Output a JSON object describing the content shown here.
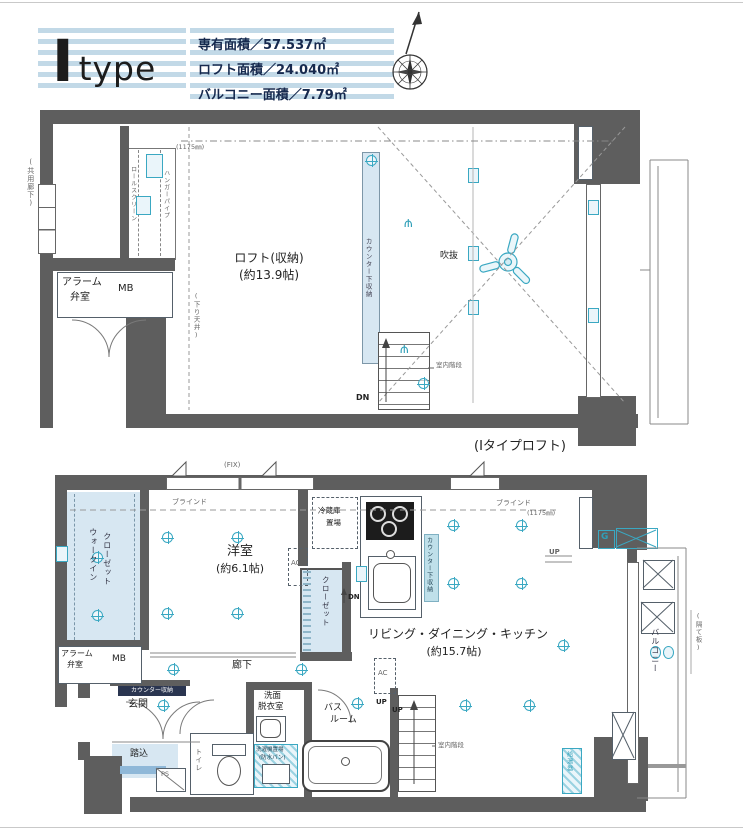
{
  "header": {
    "logo": {
      "letter": "I",
      "word": "type"
    },
    "areas": {
      "line1": "専有面積／57.537㎡",
      "line2": "ロフト面積／24.040㎡",
      "line3": "バルコニー面積／7.79㎡"
    }
  },
  "upper_plan": {
    "caption": "(Iタイプロフト)",
    "labels": {
      "corridor_side": "(共用廊下)",
      "alarm_line1": "アラーム",
      "alarm_line2": "弁室",
      "mb": "MB",
      "roll_screen": "ロールスクリーン",
      "hanger_pipe": "ハンガーパイプ",
      "dim_note": "(1175㎜)",
      "loft_name": "ロフト(収納)",
      "loft_size": "(約13.9帖)",
      "lowered_ceiling": "(下り天井)",
      "counter_storage": "カウンター下収納",
      "void": "吹抜",
      "dn": "DN",
      "stairs_note": "室内階段"
    }
  },
  "lower_plan": {
    "labels": {
      "fix": "(FIX)",
      "blind": "ブラインド",
      "dim_note": "(1175㎜)",
      "wic_line1": "ウォークイン",
      "wic_line2": "クローゼット",
      "bedroom_name": "洋室",
      "bedroom_size": "(約6.1帖)",
      "closet": "クローゼット",
      "fridge_line1": "冷蔵庫",
      "fridge_line2": "置場",
      "ac": "AC",
      "counter_storage": "カウンター下収納",
      "dn": "DN",
      "ldk_name": "リビング・ダイニング・キッチン",
      "ldk_size": "(約15.7帖)",
      "gas_meter": "G",
      "up": "UP",
      "balcony": "バルコニー",
      "partition": "(隔て板)",
      "water_heater": "給湯器",
      "alarm_line1": "アラーム",
      "alarm_line2": "弁室",
      "mb": "MB",
      "hallway": "廊下",
      "entrance": "玄関",
      "entrance_counter": "カウンター収納",
      "step_in": "踏込",
      "ps": "PS",
      "toilet": "トイレ",
      "washroom_line1": "洗面",
      "washroom_line2": "脱衣室",
      "washer": "洗濯機置場",
      "waterproof_pan": "(防水パン)",
      "bathroom_line1": "バス",
      "bathroom_line2": "ルーム",
      "stairs_note": "室内階段"
    }
  },
  "colors": {
    "wall": "#5e5e5e",
    "accent_teal": "#3aa8c2",
    "fill_blue": "#d7e7f2",
    "stripe_blue": "#c2d9e7",
    "navy_text": "#16294e"
  }
}
